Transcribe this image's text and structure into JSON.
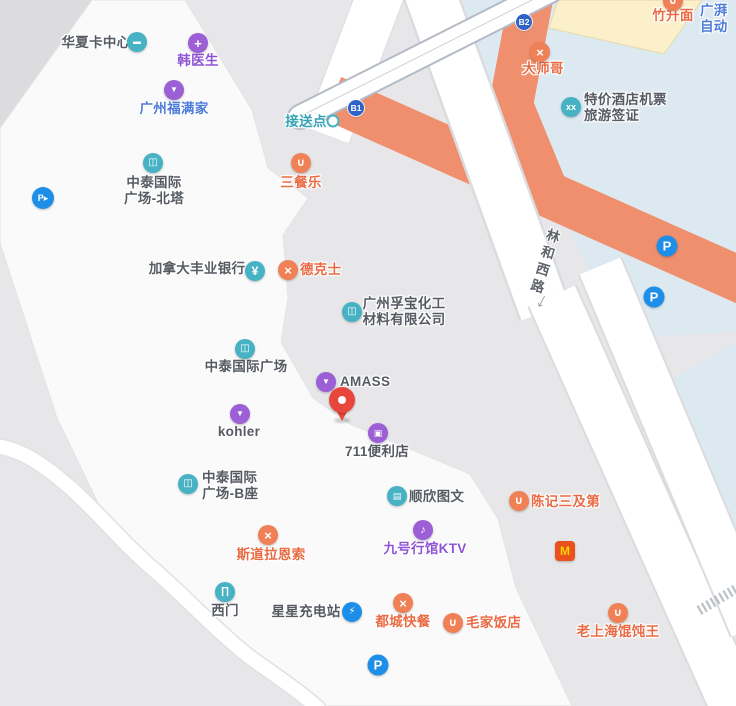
{
  "colors": {
    "icon": {
      "teal": "#46b2c3",
      "purple": "#9c5fd6",
      "orange": "#f08055",
      "blue": "#1d8fe8",
      "mcd": "#e8511d",
      "dotwhite": "#ffffff",
      "badge": "#2f63c8"
    },
    "text": {
      "dark": "#565b63",
      "orange": "#e96b45",
      "purple": "#8f55d4",
      "blue": "#4d7cd8",
      "teal": "#35a3b5",
      "road": "#5f646b"
    },
    "map": {
      "base": "#e7e7e9",
      "block_white": "#fafafa",
      "water_blue": "#dde9f1",
      "overpass_orange": "#ef8f6d",
      "building_beige": "#fcf0cb",
      "pin_red": "#e8463c",
      "mcd_m_yellow": "#ffd200"
    }
  },
  "icon_glyphs": {
    "card-icon": "▬",
    "medical-icon": "+",
    "bag-icon": "▼",
    "building-icon": "◫",
    "parking-entry-icon": "P▸",
    "bowl-icon": "∪",
    "yen-icon": "¥",
    "utensils-icon": "×",
    "briefcase-icon": "▣",
    "printer-icon": "▤",
    "mic-icon": "♪",
    "mcdonalds-icon": "M",
    "gate-icon": "∏",
    "charging-icon": "⚡",
    "parking-icon": "P",
    "ticket-icon": "xx",
    "dot-icon": ""
  },
  "road": {
    "name": "林和西路",
    "arrow": "↓"
  },
  "pin": {
    "x": 342,
    "y": 420
  },
  "badges": [
    {
      "id": "exit-b1",
      "text": "B1",
      "x": 356,
      "y": 108
    },
    {
      "id": "exit-b2",
      "text": "B2",
      "x": 524,
      "y": 22
    }
  ],
  "pois": [
    {
      "id": "huaxia-card-center",
      "icon": {
        "x": 137,
        "y": 42,
        "glyph": "card-icon",
        "bg": "teal"
      },
      "label": {
        "text": "华夏卡中心",
        "x": 96,
        "y": 43,
        "color": "dark"
      }
    },
    {
      "id": "han-doctor",
      "icon": {
        "x": 198,
        "y": 43,
        "glyph": "medical-icon",
        "bg": "purple"
      },
      "label": {
        "text": "韩医生",
        "x": 198,
        "y": 61,
        "color": "purple"
      }
    },
    {
      "id": "guangzhou-fumanjia",
      "icon": {
        "x": 174,
        "y": 90,
        "glyph": "bag-icon",
        "bg": "purple"
      },
      "label": {
        "text": "广州福满家",
        "x": 174,
        "y": 109,
        "color": "blue"
      }
    },
    {
      "id": "zhongtai-north-tower",
      "icon": {
        "x": 153,
        "y": 163,
        "glyph": "building-icon",
        "bg": "teal"
      },
      "label": {
        "text": "中泰国际\n广场-北塔",
        "x": 154,
        "y": 191,
        "color": "dark"
      }
    },
    {
      "id": "parking-entrance-west",
      "icon": {
        "x": 43,
        "y": 198,
        "glyph": "parking-entry-icon",
        "bg": "blue",
        "size": 22
      }
    },
    {
      "id": "sancanle",
      "icon": {
        "x": 301,
        "y": 163,
        "glyph": "bowl-icon",
        "bg": "orange"
      },
      "label": {
        "text": "三餐乐",
        "x": 301,
        "y": 183,
        "color": "orange"
      }
    },
    {
      "id": "scotiabank-canada",
      "icon": {
        "x": 255,
        "y": 271,
        "glyph": "yen-icon",
        "bg": "teal"
      },
      "label": {
        "text": "加拿大丰业银行",
        "x": 197,
        "y": 269,
        "color": "dark"
      }
    },
    {
      "id": "dicos",
      "icon": {
        "x": 288,
        "y": 270,
        "glyph": "utensils-icon",
        "bg": "orange"
      },
      "label": {
        "text": "德克士",
        "x": 300,
        "y": 270,
        "color": "orange",
        "align": "left"
      }
    },
    {
      "id": "fubao-chemical",
      "icon": {
        "x": 352,
        "y": 312,
        "glyph": "building-icon",
        "bg": "teal"
      },
      "label": {
        "text": "广州孚宝化工\n材料有限公司",
        "x": 404,
        "y": 312,
        "color": "dark"
      }
    },
    {
      "id": "zhongtai-plaza",
      "icon": {
        "x": 245,
        "y": 349,
        "glyph": "building-icon",
        "bg": "teal"
      },
      "label": {
        "text": "中泰国际广场",
        "x": 246,
        "y": 367,
        "color": "dark"
      }
    },
    {
      "id": "amass",
      "icon": {
        "x": 326,
        "y": 382,
        "glyph": "bag-icon",
        "bg": "purple"
      },
      "label": {
        "text": "AMASS",
        "x": 340,
        "y": 382,
        "color": "dark",
        "align": "left"
      }
    },
    {
      "id": "kohler",
      "icon": {
        "x": 240,
        "y": 414,
        "glyph": "bag-icon",
        "bg": "purple"
      },
      "label": {
        "text": "kohler",
        "x": 239,
        "y": 432,
        "color": "dark"
      }
    },
    {
      "id": "store-711",
      "icon": {
        "x": 378,
        "y": 433,
        "glyph": "briefcase-icon",
        "bg": "purple"
      },
      "label": {
        "text": "711便利店",
        "x": 377,
        "y": 452,
        "color": "dark"
      }
    },
    {
      "id": "zhongtai-b-tower",
      "icon": {
        "x": 188,
        "y": 484,
        "glyph": "building-icon",
        "bg": "teal"
      },
      "label": {
        "text": "中泰国际\n广场-B座",
        "x": 202,
        "y": 486,
        "color": "dark",
        "align": "left"
      }
    },
    {
      "id": "shunxin-print",
      "icon": {
        "x": 397,
        "y": 496,
        "glyph": "printer-icon",
        "bg": "teal"
      },
      "label": {
        "text": "顺欣图文",
        "x": 409,
        "y": 497,
        "color": "dark",
        "align": "left"
      }
    },
    {
      "id": "stora-enso",
      "icon": {
        "x": 268,
        "y": 535,
        "glyph": "utensils-icon",
        "bg": "orange"
      },
      "label": {
        "text": "斯道拉恩索",
        "x": 271,
        "y": 555,
        "color": "orange"
      }
    },
    {
      "id": "ktv-no9",
      "icon": {
        "x": 423,
        "y": 530,
        "glyph": "mic-icon",
        "bg": "purple"
      },
      "label": {
        "text": "九号行馆KTV",
        "x": 425,
        "y": 549,
        "color": "purple"
      }
    },
    {
      "id": "chenji-sanjidi",
      "icon": {
        "x": 519,
        "y": 501,
        "glyph": "bowl-icon",
        "bg": "orange"
      },
      "label": {
        "text": "陈记三及第",
        "x": 531,
        "y": 502,
        "color": "orange",
        "align": "left"
      }
    },
    {
      "id": "mcdonalds",
      "icon": {
        "x": 565,
        "y": 551,
        "glyph": "mcdonalds-icon",
        "bg": "mcd",
        "shape": "square"
      }
    },
    {
      "id": "ximen-gate",
      "icon": {
        "x": 225,
        "y": 592,
        "glyph": "gate-icon",
        "bg": "teal"
      },
      "label": {
        "text": "西门",
        "x": 225,
        "y": 611,
        "color": "dark"
      }
    },
    {
      "id": "xingxing-charging",
      "icon": {
        "x": 352,
        "y": 612,
        "glyph": "charging-icon",
        "bg": "blue"
      },
      "label": {
        "text": "星星充电站",
        "x": 306,
        "y": 612,
        "color": "dark"
      }
    },
    {
      "id": "ducheng-fastfood",
      "icon": {
        "x": 403,
        "y": 603,
        "glyph": "utensils-icon",
        "bg": "orange"
      },
      "label": {
        "text": "都城快餐",
        "x": 403,
        "y": 622,
        "color": "orange"
      }
    },
    {
      "id": "parking-south",
      "icon": {
        "x": 378,
        "y": 665,
        "glyph": "parking-icon",
        "bg": "blue",
        "size": 21
      }
    },
    {
      "id": "maojia-restaurant",
      "icon": {
        "x": 453,
        "y": 623,
        "glyph": "bowl-icon",
        "bg": "orange"
      },
      "label": {
        "text": "毛家饭店",
        "x": 466,
        "y": 623,
        "color": "orange",
        "align": "left"
      }
    },
    {
      "id": "laoshanghai-wonton",
      "icon": {
        "x": 618,
        "y": 613,
        "glyph": "bowl-icon",
        "bg": "orange"
      },
      "label": {
        "text": "老上海馄饨王",
        "x": 618,
        "y": 632,
        "color": "orange"
      }
    },
    {
      "id": "dashige",
      "icon": {
        "x": 540,
        "y": 52,
        "glyph": "utensils-icon",
        "bg": "orange"
      },
      "label": {
        "text": "大师哥",
        "x": 543,
        "y": 69,
        "color": "orange"
      }
    },
    {
      "id": "tejia-hotel-tickets",
      "icon": {
        "x": 571,
        "y": 107,
        "glyph": "ticket-icon",
        "bg": "teal"
      },
      "label": {
        "text": "特价酒店机票\n旅游签证",
        "x": 584,
        "y": 108,
        "color": "dark",
        "align": "left"
      }
    },
    {
      "id": "zhushengmian",
      "icon": {
        "x": 673,
        "y": 1,
        "glyph": "bowl-icon",
        "bg": "orange"
      },
      "label": {
        "text": "竹升面",
        "x": 673,
        "y": 16,
        "color": "orange"
      }
    },
    {
      "id": "guangpai-auto",
      "label": {
        "text": "广湃\n自动",
        "x": 700,
        "y": 19,
        "color": "blue",
        "align": "left"
      }
    },
    {
      "id": "jiesongdian-pickup",
      "icon": {
        "x": 333,
        "y": 121,
        "glyph": "dot-icon",
        "bg": "dotwhite",
        "size": 9
      },
      "label": {
        "text": "接送点",
        "x": 306,
        "y": 122,
        "color": "teal"
      }
    },
    {
      "id": "parking-east-1",
      "icon": {
        "x": 667,
        "y": 246,
        "glyph": "parking-icon",
        "bg": "blue",
        "size": 21
      }
    },
    {
      "id": "parking-east-2",
      "icon": {
        "x": 654,
        "y": 297,
        "glyph": "parking-icon",
        "bg": "blue",
        "size": 21
      }
    }
  ]
}
